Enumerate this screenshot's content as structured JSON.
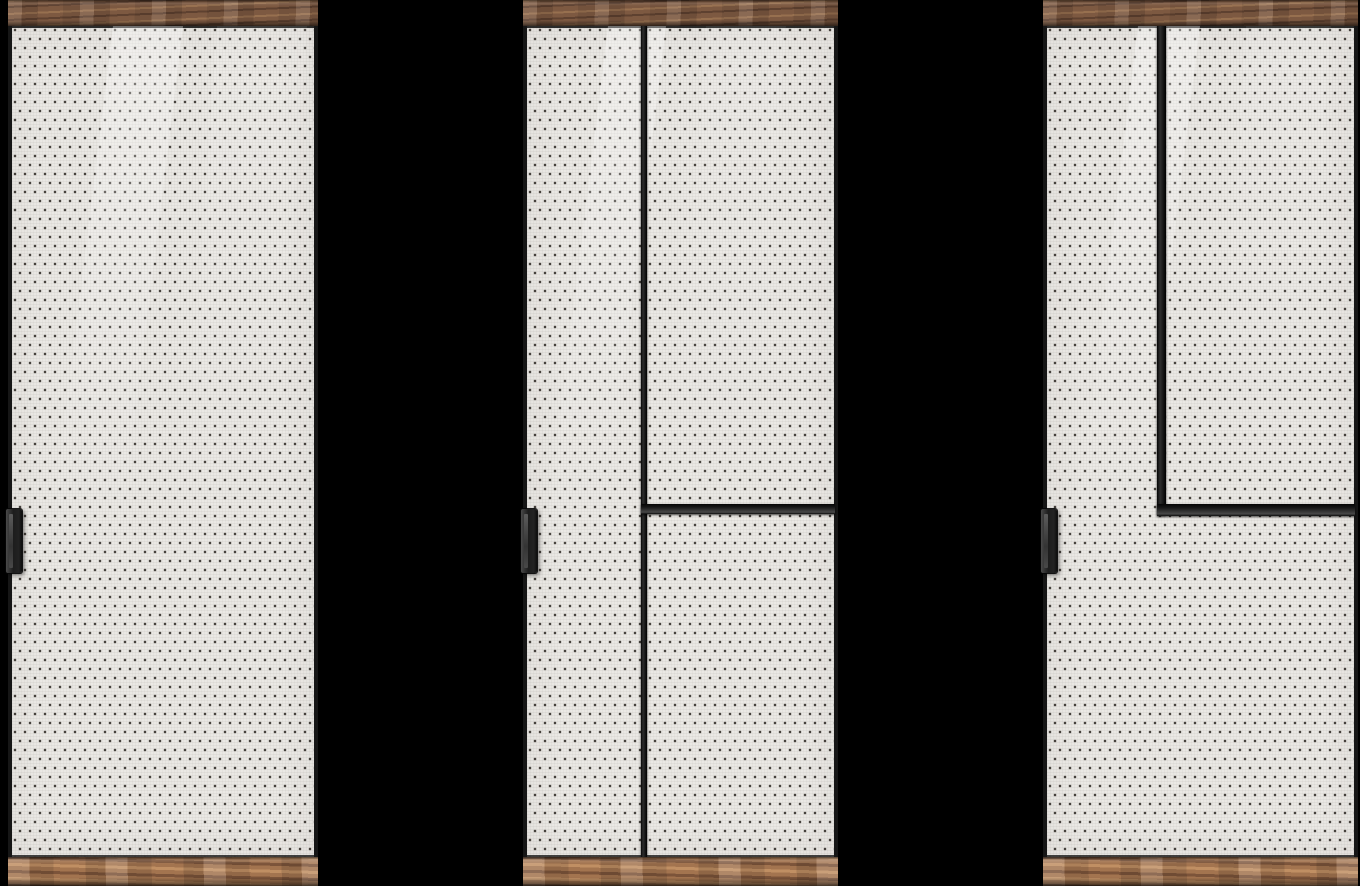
{
  "scene": {
    "type": "3d-product-render",
    "subject": "Three sliding wardrobe door design variants with wood rails, perforated glass panels, black dividers and recessed handles",
    "background": "#000000",
    "door_count": 3
  },
  "colors": {
    "background": "#000000",
    "glass": "#eae8e4",
    "dot": "#46423d",
    "frame_dark": "#161616",
    "frame_mid": "#2e2e2e",
    "frame_highlight": "#484848",
    "handle_dark": "#1d1d1d",
    "handle_light": "#4a4a4a",
    "wood_top_base": "#7d5941",
    "wood_top_light": "#97704f",
    "wood_top_dark": "#5e4130",
    "wood_bottom_base": "#a3744f",
    "wood_bottom_light": "#c08f63",
    "wood_bottom_dark": "#7c543a"
  },
  "doors": [
    {
      "name": "variant-1",
      "layout": "Single full-height perforated panel, no dividers",
      "handle": "black recessed bar handle on left edge at mid height",
      "top_rail": "dark walnut wood strip",
      "bottom_rail": "light walnut wood strip"
    },
    {
      "name": "variant-2",
      "layout": "Full-height vertical divider near left edge; horizontal rail across right section at mid height",
      "handle": "black recessed bar handle on left edge at mid height",
      "top_rail": "dark walnut wood strip",
      "bottom_rail": "light walnut wood strip"
    },
    {
      "name": "variant-3",
      "layout": "Vertical divider near left edge from top to mid height meeting horizontal rail across right section, forming inset top-right pane",
      "handle": "black recessed bar handle on left edge at mid height",
      "top_rail": "dark walnut wood strip",
      "bottom_rail": "light walnut wood strip"
    }
  ]
}
